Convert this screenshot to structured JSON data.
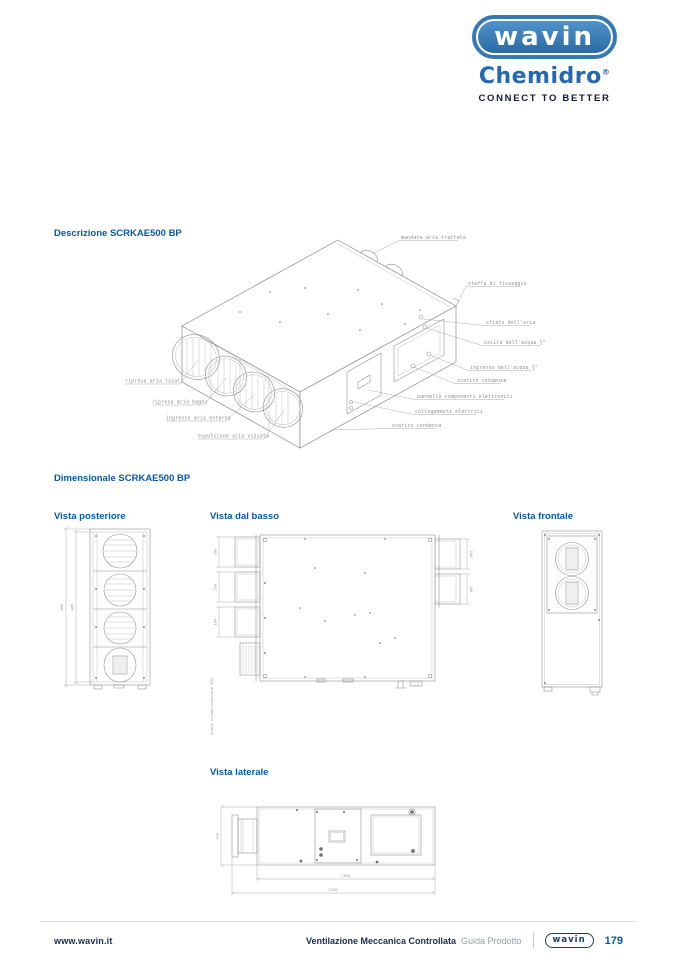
{
  "header": {
    "logo_text": "wavin",
    "brand": "Chemidro",
    "brand_reg": "®",
    "tagline": "CONNECT TO BETTER"
  },
  "sections": {
    "description": "Descrizione SCRKAE500 BP",
    "dimensional": "Dimensionale SCRKAE500 BP",
    "view_posteriore": "Vista posteriore",
    "view_dal_basso": "Vista dal basso",
    "view_frontale": "Vista frontale",
    "view_laterale": "Vista laterale"
  },
  "callouts": {
    "mandata": "mandata aria trattata",
    "staffa": "staffa di fissaggio",
    "sfiato": "sfiato dell'aria",
    "uscita_acqua": "uscita dell'acqua ¾\"",
    "ingresso_acqua": "ingresso dell'acqua ¾\"",
    "scarico_dx": "scarico condensa",
    "pannello": "pannello componenti elettronici",
    "collegamenti": "collegamenti elettrici",
    "scarico_basso": "scarico condensa",
    "ripresa_locali": "ripresa aria locali",
    "ripresa_bagni": "ripresa aria bagni",
    "ingresso_esterna": "ingresso aria esterna",
    "espulsione": "espulsione aria viziata"
  },
  "dimensions": {
    "posteriore": {
      "outer": "850",
      "inner": "805"
    },
    "dal_basso": {
      "left": [
        "200",
        "160",
        "160"
      ],
      "right": [
        "160",
        "160"
      ],
      "scale_note": "Scala visualizzazione 50%"
    },
    "laterale": {
      "height": "310",
      "len1": "1030",
      "len2": "1250"
    }
  },
  "footer": {
    "website": "www.wavin.it",
    "doc_title": "Ventilazione Meccanica Controllata",
    "doc_subtitle": "Guida Prodotto",
    "logo_text": "wavin",
    "page_number": "179"
  },
  "colors": {
    "heading_blue": "#0a58a5",
    "wavin_logo_blue": "#2e6da4",
    "chemidro_blue": "#2468b2",
    "footer_navy": "#1b2b4b",
    "drawing_gray": "#8c8c8c"
  }
}
